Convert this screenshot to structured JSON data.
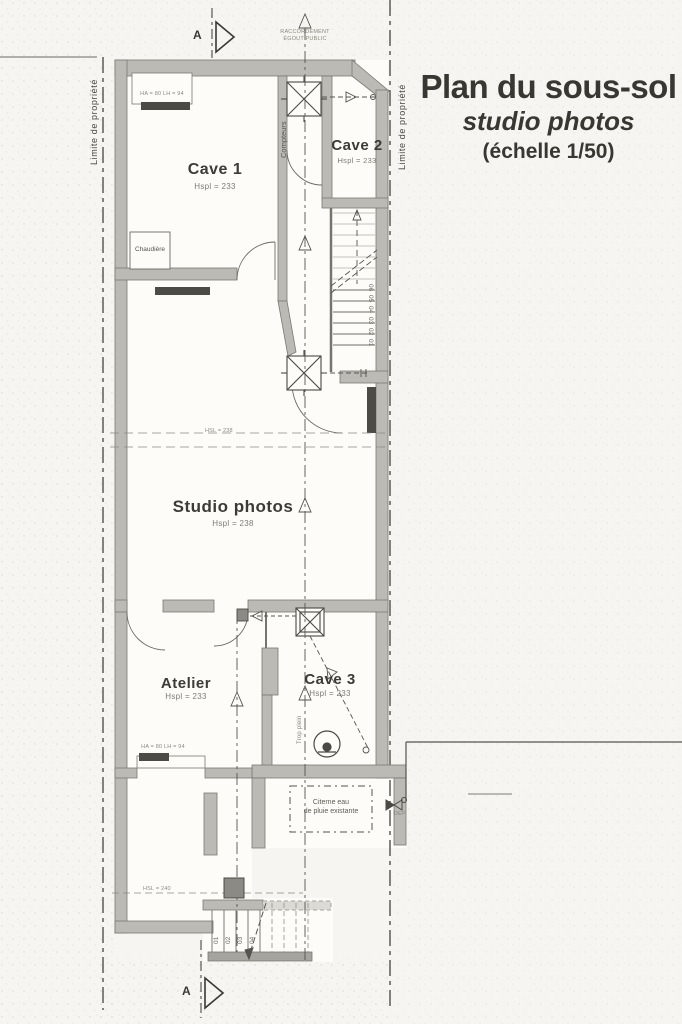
{
  "title": {
    "main": "Plan du sous-sol",
    "sub": "studio photos",
    "scale": "(échelle 1/50)"
  },
  "section_markers": {
    "top": "A",
    "bottom": "A"
  },
  "property": {
    "left": "Limite de propriété",
    "right": "Limite de propriété"
  },
  "utilities": {
    "raccordement1": "RACCORDEMENT",
    "raccordement2": "ÉGOUT PUBLIC",
    "compteurs": "Compteurs",
    "trop_plein": "Trop plein",
    "dep": "DEP"
  },
  "rooms": {
    "cave1": {
      "name": "Cave 1",
      "height": "Hspl = 233"
    },
    "cave2": {
      "name": "Cave 2",
      "height": "Hspl = 233"
    },
    "studio": {
      "name": "Studio photos",
      "height": "Hspl = 238"
    },
    "atelier": {
      "name": "Atelier",
      "height": "Hspl = 233"
    },
    "cave3": {
      "name": "Cave 3",
      "height": "Hspl = 233"
    }
  },
  "equipment": {
    "chaudiere": "Chaudière",
    "citerne1": "Citerne eau",
    "citerne2": "de pluie existante"
  },
  "dimensions": {
    "hsl_studio": "HSL = 238",
    "hsl_corridor": "HSL = 240",
    "window_cave1": "HA = 80  LH = 94",
    "window_atelier": "HA = 80  LH = 94"
  },
  "stairs": {
    "upper": [
      "06",
      "05",
      "04",
      "03",
      "02",
      "01"
    ],
    "lower": [
      "01",
      "02",
      "03",
      "04"
    ]
  },
  "colors": {
    "wall": "#bcbab4",
    "wall_dark": "#4c4b45",
    "ink": "#44433d",
    "paper": "#f6f5f1"
  }
}
